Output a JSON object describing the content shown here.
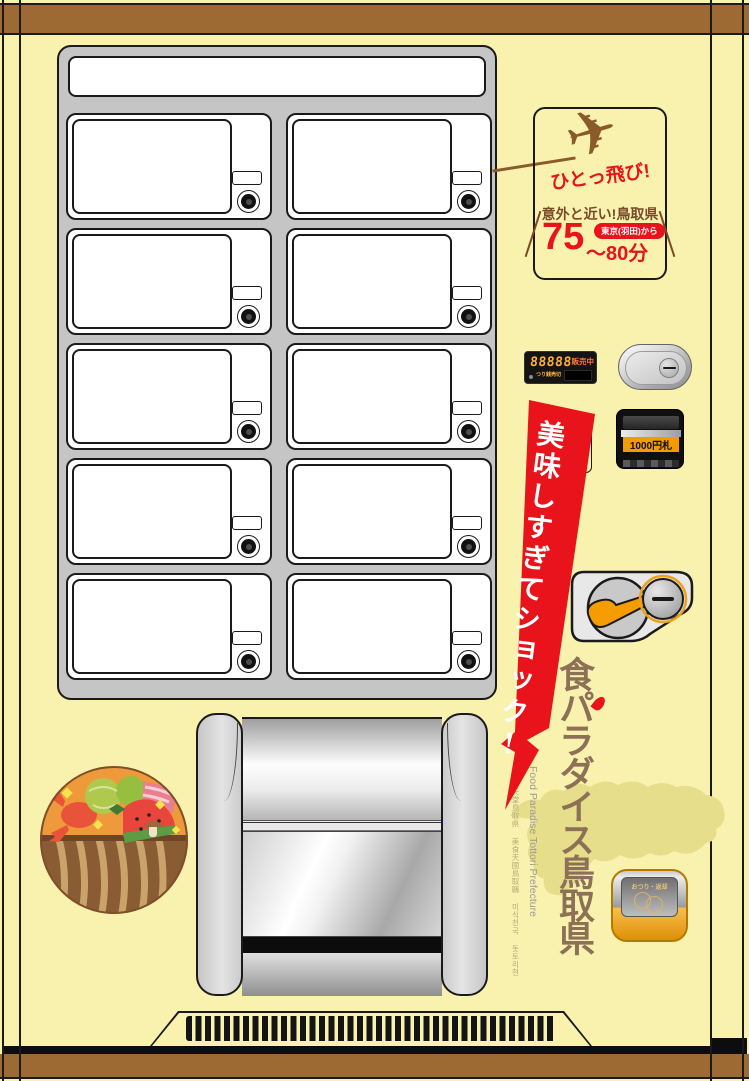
{
  "flight_panel": {
    "catchphrase": "ひとっ飛び!",
    "subtitle": "意外と近い!鳥取県",
    "minutes": "75",
    "minutes_range": "〜80分",
    "origin_badge": "東京(羽田)から"
  },
  "money_panel": {
    "display_digits": "88888",
    "display_status": "販売中",
    "display_sub_left": "つり銭",
    "display_sub_right": "売切",
    "bill_slot_label": "1000円札",
    "coin_return_label": "おつり・返却"
  },
  "sale_banner": {
    "text": "美味しすぎてショック!"
  },
  "branding": {
    "main_vertical": "食パラダイス鳥取県",
    "english": "Food Paradise Tottori Prefecture",
    "multilingual": "美食天堂鳥取県 美食天國鳥取縣 미식천국 돗토리현"
  },
  "product_grid": {
    "rows": 5,
    "cols": 2
  },
  "colors": {
    "body": "#f9f2ae",
    "trim_brown": "#9c6a32",
    "accent_red": "#e8131b",
    "brand_brown": "#8d7157",
    "gold": "#f0a11a",
    "panel_gray": "#c5c5c6",
    "map_khaki": "#e6de8a"
  }
}
